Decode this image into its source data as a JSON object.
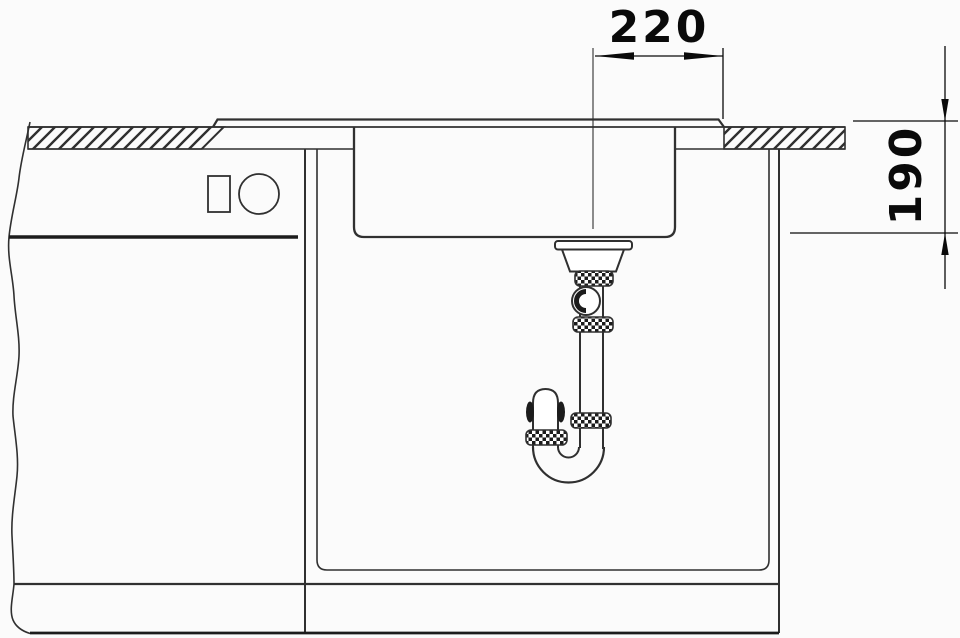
{
  "drawing": {
    "labels": {
      "horizontal_dimension": "220",
      "vertical_dimension": "190"
    },
    "colors": {
      "line": "#303030",
      "heavy_line": "#1c1c1c",
      "dimension": "#0a0a0a",
      "background": "#fbfbfb"
    }
  }
}
